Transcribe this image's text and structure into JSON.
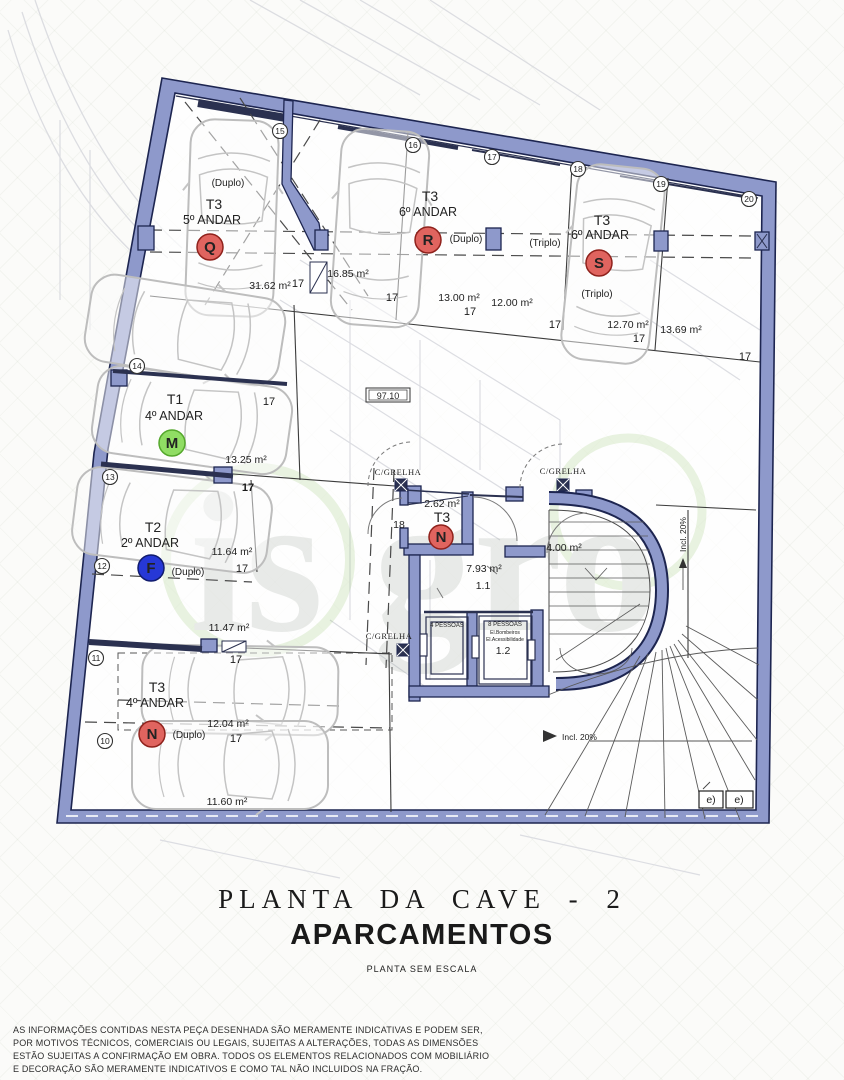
{
  "plan": {
    "watermark": "is gro",
    "markers": {
      "q": {
        "unit": "T3",
        "floor": "5º ANDAR",
        "mode": "(Duplo)",
        "letter": "Q"
      },
      "r": {
        "unit": "T3",
        "floor": "6º ANDAR",
        "mode": "(Duplo)",
        "letter": "R"
      },
      "s": {
        "unit": "T3",
        "floor": "6º ANDAR",
        "mode": "(Triplo)",
        "letter": "S"
      },
      "m": {
        "unit": "T1",
        "floor": "4º ANDAR",
        "letter": "M"
      },
      "f": {
        "unit": "T2",
        "floor": "2º ANDAR",
        "mode": "(Duplo)",
        "letter": "F"
      },
      "n": {
        "unit": "T3",
        "floor": "4º ANDAR",
        "mode": "(Duplo)",
        "letter": "N"
      }
    },
    "areas": {
      "a3162": "31.62 m²",
      "a1685": "16.85 m²",
      "a1300": "13.00 m²",
      "a1200": "12.00 m²",
      "a1270": "12.70 m²",
      "a1369": "13.69 m²",
      "a1325": "13.25 m²",
      "a1164": "11.64 m²",
      "a1147": "11.47 m²",
      "a1204": "12.04 m²",
      "a1160": "11.60 m²",
      "a262": "2.62 m²",
      "a400": "4.00 m²",
      "a793": "7.93 m²"
    },
    "rooms": {
      "hall_unit": "T3",
      "hall_letter": "N",
      "door": "18",
      "corridor": "1.1",
      "lobby": "1.2"
    },
    "lifts": {
      "l1": "4 PESSOAS",
      "l2a": "8 PESSOAS",
      "l2b": "El.Bombeiros",
      "l2c": "El.Acessibilidade"
    },
    "labels": {
      "grelha": "C/GRELHA",
      "incl": "Incl. 20%",
      "level": "97.10",
      "dim17": "17",
      "e": "e)"
    },
    "bubbles": {
      "n10": "10",
      "n11": "11",
      "n12": "12",
      "n13": "13",
      "n14": "14",
      "n15": "15",
      "n16": "16",
      "n17": "17",
      "n18": "18",
      "n19": "19",
      "n20": "20"
    }
  },
  "title_block": {
    "title": "PLANTA  DA  CAVE  - 2",
    "subtitle": "APARCAMENTOS",
    "note": "PLANTA SEM ESCALA"
  },
  "disclaimer": {
    "line1": "AS INFORMAÇÕES CONTIDAS NESTA PEÇA DESENHADA SÃO MERAMENTE INDICATIVAS E PODEM SER,",
    "line2": "POR MOTIVOS TÉCNICOS, COMERCIAIS OU LEGAIS, SUJEITAS A ALTERAÇÕES, TODAS AS DIMENSÕES",
    "line3": "ESTÃO SUJEITAS A CONFIRMAÇÃO EM OBRA. TODOS  OS ELEMENTOS RELACIONADOS COM MOBILIÁRIO",
    "line4": "E DECORAÇÃO SÃO MERAMENTE INDICATIVOS E COMO TAL NÃO INCLUIDOS NA FRAÇÃO."
  },
  "colors": {
    "wall": "#8e99cb",
    "wall_dark": "#1d2550",
    "marker_red": "#e0645f",
    "marker_green": "#90dd64",
    "marker_blue": "#2638d6"
  }
}
